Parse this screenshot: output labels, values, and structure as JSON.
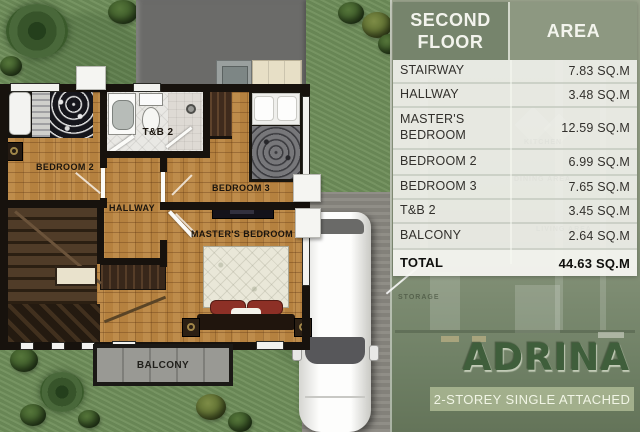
{
  "table": {
    "header": {
      "col1": "SECOND FLOOR",
      "col2": "AREA"
    },
    "rows": [
      {
        "name": "STAIRWAY",
        "area": "7.83 SQ.M"
      },
      {
        "name": "HALLWAY",
        "area": "3.48 SQ.M"
      },
      {
        "name": "MASTER'S BEDROOM",
        "area": "12.59 SQ.M"
      },
      {
        "name": "BEDROOM 2",
        "area": "6.99 SQ.M"
      },
      {
        "name": "BEDROOM 3",
        "area": "7.65 SQ.M"
      },
      {
        "name": "T&B 2",
        "area": "3.45 SQ.M"
      },
      {
        "name": "BALCONY",
        "area": "2.64 SQ.M"
      }
    ],
    "total": {
      "name": "TOTAL",
      "area": "44.63 SQ.M"
    }
  },
  "branding": {
    "model_name": "ADRINA",
    "subtitle": "2-STOREY SINGLE ATTACHED"
  },
  "floor_plan": {
    "labels": {
      "bedroom2": "BEDROOM 2",
      "bedroom3": "BEDROOM 3",
      "hallway": "HALLWAY",
      "master": "MASTER'S BEDROOM",
      "tb2": "T&B 2",
      "balcony": "BALCONY"
    }
  },
  "ghost_plan": {
    "labels": {
      "storage": "STORAGE",
      "kitchen": "KITCHEN",
      "dining": "DINING AREA",
      "living": "LIVING AREA"
    }
  },
  "colors": {
    "header_green": "#76846c",
    "panel_green": "#8a967c",
    "brand_green": "#3f5e3b",
    "grass": "#6f8e5a",
    "parquet": "#b5813f"
  }
}
